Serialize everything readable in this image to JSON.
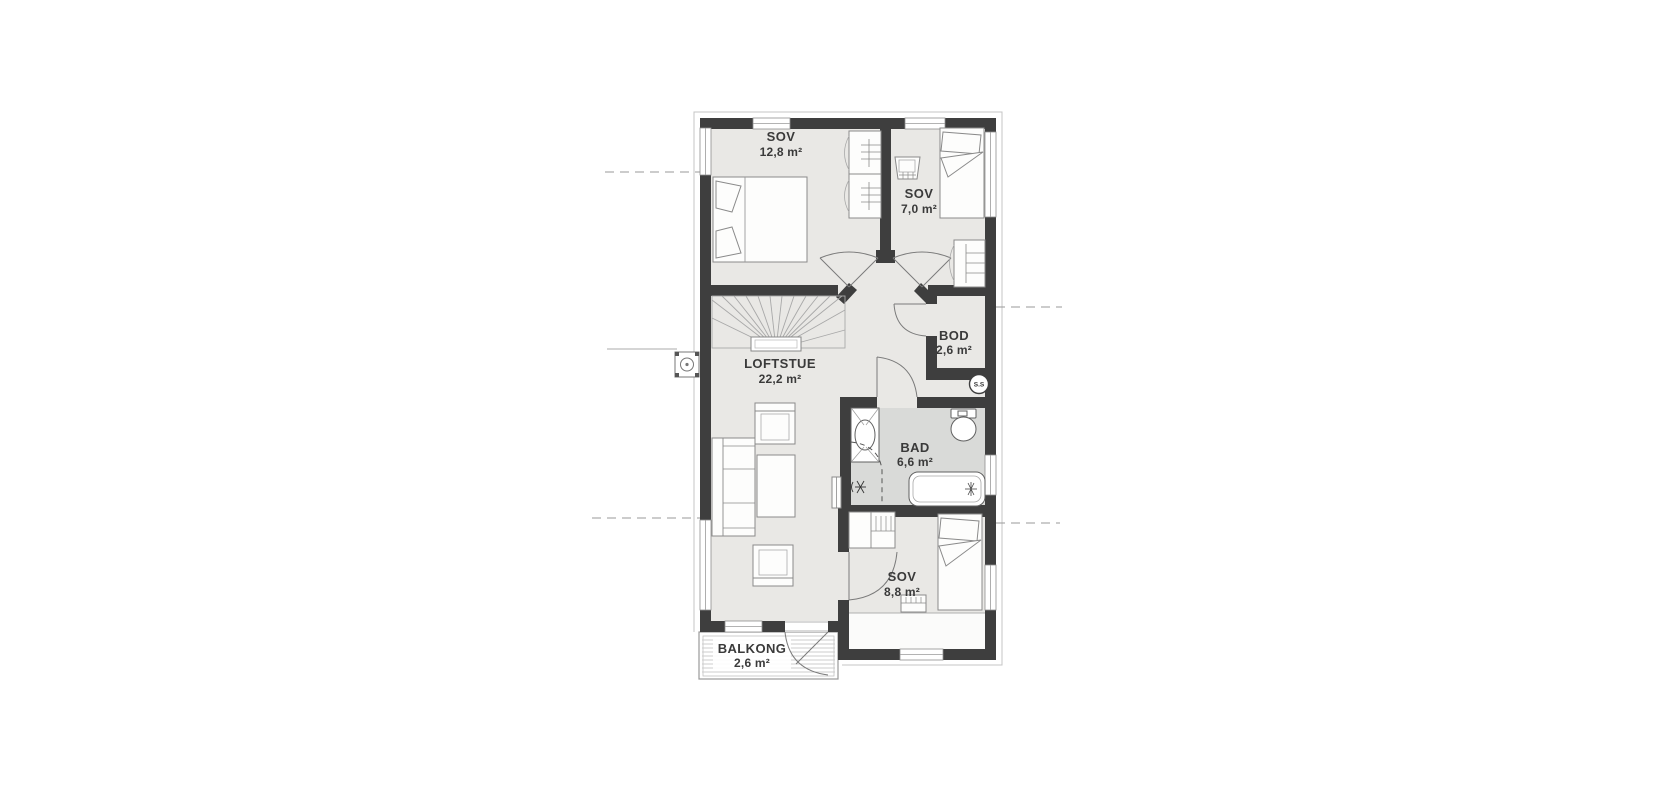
{
  "floor_plan": {
    "rooms": [
      {
        "key": "sov-12",
        "name": "SOV",
        "area": "12,8 m²"
      },
      {
        "key": "sov-7",
        "name": "SOV",
        "area": "7,0 m²"
      },
      {
        "key": "bod",
        "name": "BOD",
        "area": "2,6 m²"
      },
      {
        "key": "loftstue",
        "name": "LOFTSTUE",
        "area": "22,2 m²"
      },
      {
        "key": "bad",
        "name": "BAD",
        "area": "6,6 m²"
      },
      {
        "key": "sov-8",
        "name": "SOV",
        "area": "8,8 m²"
      },
      {
        "key": "balkong",
        "name": "BALKONG",
        "area": "2,6 m²"
      }
    ],
    "labels": {
      "shaft_badge": "S.S"
    },
    "colors": {
      "wall": "#3e3e3e",
      "floor": "#e9e8e5",
      "bathroom_floor": "#d9dad8",
      "furniture_line": "#8a8a8a",
      "background": "#ffffff"
    }
  }
}
